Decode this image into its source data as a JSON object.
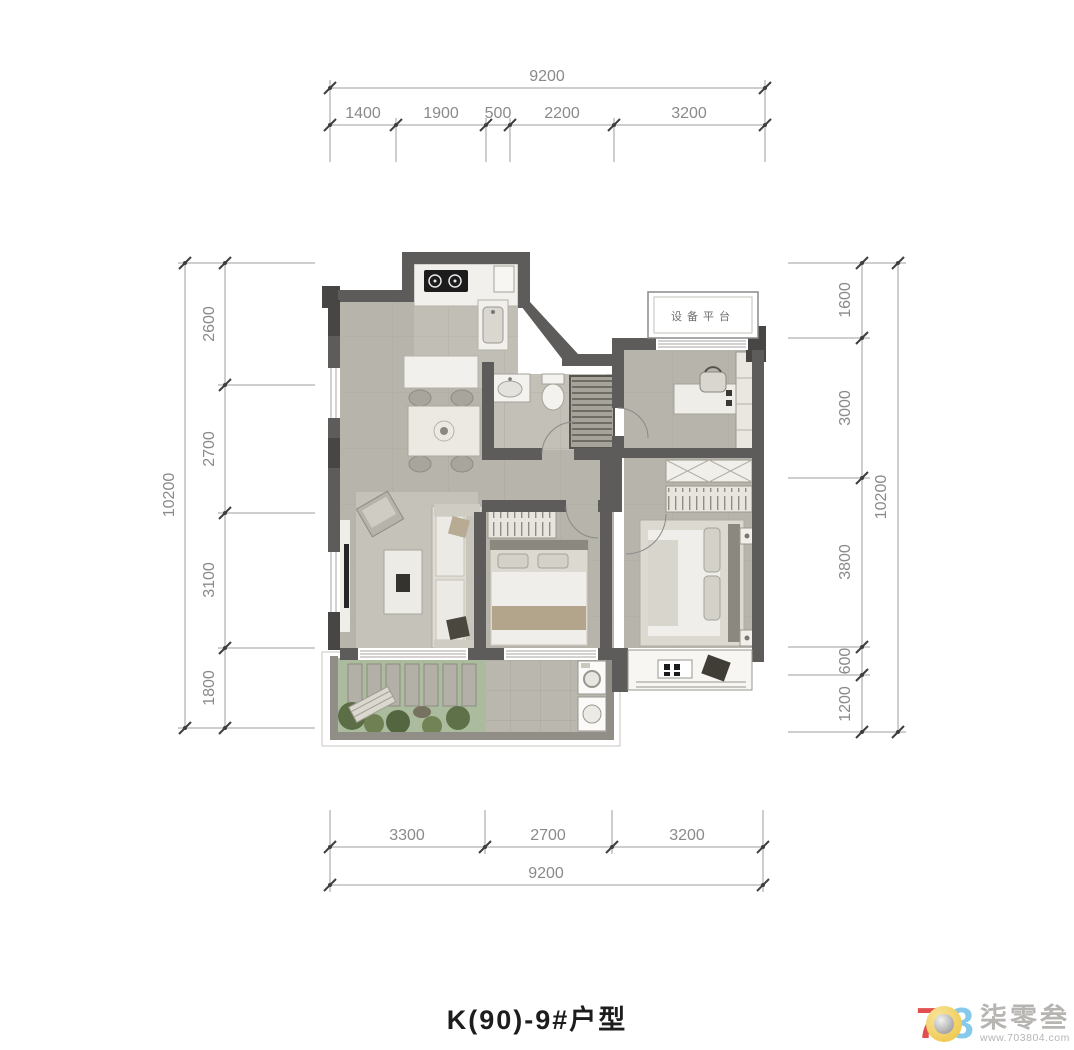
{
  "title": "K(90)-9#户型",
  "plan": {
    "equipment_platform": "设备平台"
  },
  "dimensions": {
    "top": {
      "total": "9200",
      "segments": [
        "1400",
        "1900",
        "500",
        "2200",
        "3200"
      ]
    },
    "bottom": {
      "total": "9200",
      "segments": [
        "3300",
        "2700",
        "3200"
      ]
    },
    "left": {
      "total": "10200",
      "segments": [
        "2600",
        "2700",
        "3100",
        "1800"
      ]
    },
    "right": {
      "total": "10200",
      "segments": [
        "1600",
        "3000",
        "3800",
        "600",
        "1200"
      ]
    }
  },
  "watermark": {
    "digit_7": "7",
    "digit_3": "3",
    "name": "柒零叁",
    "url": "www.703804.com"
  },
  "colors": {
    "wall": "#5d5c5a",
    "wall_dark": "#474645",
    "floor": "#b7b4ab",
    "kitchen_floor": "#c1beb5",
    "garden": "#aabb9e",
    "dim_text": "#8a8a8a",
    "logo_red": "#e0504f",
    "logo_yellow": "#edc23d",
    "logo_blue": "#86c9ea"
  }
}
